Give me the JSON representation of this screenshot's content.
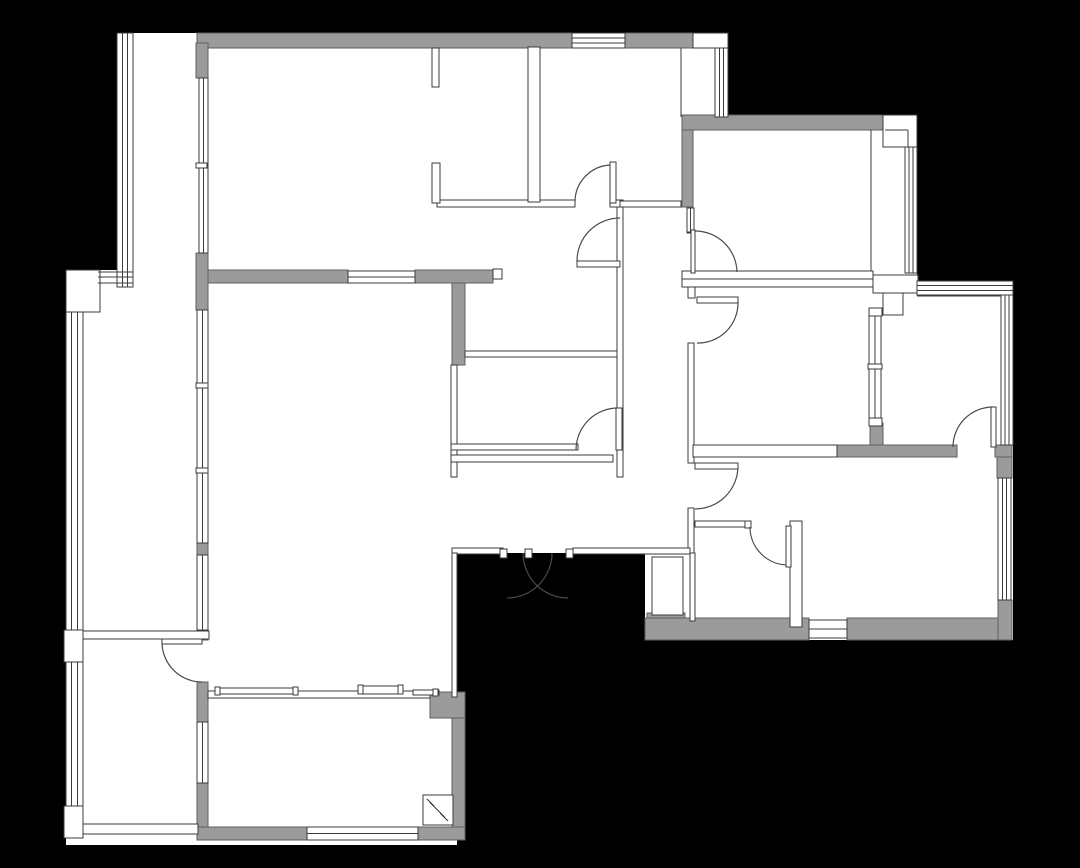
{
  "canvas": {
    "width": 1080,
    "height": 868,
    "background": "#000000"
  },
  "palette": {
    "floor": "#ffffff",
    "wall_fill": "#9b9b9b",
    "wall_edge": "#5f5f5f",
    "line": "#3b3b3b",
    "arc": "#4a4a4a"
  },
  "floor_plan": {
    "floors": [
      [
        117,
        33,
        610,
        250
      ],
      [
        682,
        115,
        235,
        168
      ],
      [
        682,
        281,
        331,
        182
      ],
      [
        645,
        445,
        368,
        195
      ],
      [
        430,
        200,
        265,
        353
      ],
      [
        66,
        270,
        391,
        575
      ]
    ],
    "gray_walls": [
      [
        197,
        33,
        375,
        15
      ],
      [
        625,
        33,
        68,
        15
      ],
      [
        196,
        43,
        12,
        35
      ],
      [
        196,
        253,
        12,
        57
      ],
      [
        208,
        270,
        140,
        13
      ],
      [
        415,
        270,
        78,
        13
      ],
      [
        452,
        283,
        13,
        82
      ],
      [
        682,
        115,
        201,
        15
      ],
      [
        682,
        130,
        11,
        77
      ],
      [
        197,
        543,
        11,
        12
      ],
      [
        197,
        630,
        11,
        10
      ],
      [
        197,
        682,
        11,
        40
      ],
      [
        197,
        783,
        11,
        57
      ],
      [
        452,
        697,
        13,
        143
      ],
      [
        197,
        827,
        110,
        13
      ],
      [
        418,
        827,
        47,
        13
      ],
      [
        430,
        692,
        35,
        26
      ],
      [
        647,
        613,
        38,
        27
      ],
      [
        645,
        618,
        164,
        22
      ],
      [
        847,
        618,
        165,
        22
      ],
      [
        870,
        423,
        13,
        34
      ],
      [
        837,
        445,
        120,
        12
      ],
      [
        995,
        445,
        17,
        12
      ],
      [
        997,
        457,
        15,
        21
      ],
      [
        998,
        600,
        14,
        40
      ]
    ],
    "thin_walls": [
      [
        437,
        200,
        138,
        7
      ],
      [
        610,
        200,
        13,
        7
      ],
      [
        620,
        201,
        61,
        6
      ],
      [
        432,
        48,
        7,
        39
      ],
      [
        432,
        163,
        8,
        40
      ],
      [
        528,
        47,
        12,
        155
      ],
      [
        465,
        351,
        155,
        6
      ],
      [
        451,
        365,
        6,
        112
      ],
      [
        451,
        444,
        127,
        6
      ],
      [
        451,
        455,
        162,
        7
      ],
      [
        617,
        207,
        6,
        270
      ],
      [
        688,
        272,
        7,
        26
      ],
      [
        688,
        343,
        6,
        120
      ],
      [
        688,
        508,
        6,
        45
      ],
      [
        452,
        548,
        51,
        6
      ],
      [
        573,
        548,
        117,
        6
      ],
      [
        452,
        553,
        5,
        144
      ],
      [
        695,
        521,
        52,
        6
      ],
      [
        790,
        521,
        12,
        106
      ],
      [
        690,
        553,
        5,
        68
      ],
      [
        682,
        271,
        191,
        16
      ],
      [
        873,
        275,
        45,
        18
      ],
      [
        883,
        293,
        20,
        22
      ],
      [
        83,
        824,
        115,
        10
      ],
      [
        83,
        631,
        126,
        8
      ],
      [
        208,
        691,
        222,
        7
      ],
      [
        693,
        445,
        144,
        12
      ]
    ],
    "boxes": [
      [
        66,
        270,
        34,
        42
      ],
      [
        64,
        630,
        19,
        32
      ],
      [
        64,
        806,
        19,
        32
      ],
      [
        693,
        33,
        35,
        15
      ],
      [
        883,
        115,
        34,
        32
      ],
      [
        652,
        557,
        31,
        58
      ],
      [
        493,
        269,
        9,
        10
      ],
      [
        423,
        795,
        30,
        30
      ],
      [
        869,
        308,
        13,
        8
      ],
      [
        869,
        418,
        13,
        8
      ],
      [
        687,
        228,
        7,
        5
      ],
      [
        745,
        521,
        6,
        7
      ],
      [
        500,
        549,
        7,
        9
      ],
      [
        525,
        549,
        7,
        9
      ],
      [
        566,
        549,
        7,
        9
      ]
    ],
    "windows": [
      [
        572,
        33,
        53,
        15,
        "h",
        2
      ],
      [
        715,
        48,
        13,
        69,
        "v",
        2
      ],
      [
        199,
        78,
        9,
        175,
        "v",
        1
      ],
      [
        197,
        310,
        11,
        233,
        "v",
        1
      ],
      [
        197,
        555,
        11,
        75,
        "v",
        1
      ],
      [
        197,
        722,
        11,
        61,
        "v",
        1
      ],
      [
        117,
        33,
        16,
        254,
        "v",
        2
      ],
      [
        66,
        312,
        17,
        318,
        "v",
        2
      ],
      [
        66,
        662,
        17,
        144,
        "v",
        2
      ],
      [
        687,
        208,
        7,
        24,
        "v",
        1
      ],
      [
        905,
        147,
        12,
        126,
        "v",
        2
      ],
      [
        917,
        281,
        96,
        14,
        "h",
        2
      ],
      [
        1001,
        295,
        12,
        150,
        "v",
        2
      ],
      [
        998,
        478,
        13,
        122,
        "v",
        2
      ],
      [
        809,
        620,
        38,
        18,
        "h",
        1
      ],
      [
        307,
        827,
        111,
        13,
        "h",
        1
      ],
      [
        869,
        316,
        12,
        102,
        "v",
        1
      ],
      [
        348,
        271,
        67,
        12,
        "h",
        1
      ]
    ],
    "lines": [
      [
        871,
        130,
        871,
        271
      ],
      [
        681,
        48,
        681,
        117
      ],
      [
        682,
        279,
        873,
        279
      ],
      [
        917,
        296,
        1001,
        296
      ],
      [
        885,
        130,
        908,
        130
      ],
      [
        908,
        130,
        908,
        147
      ],
      [
        98,
        272,
        133,
        272
      ],
      [
        98,
        277,
        133,
        277
      ],
      [
        98,
        283,
        133,
        283
      ],
      [
        427,
        799,
        448,
        821
      ]
    ],
    "sills": [
      [
        215,
        688,
        83,
        6
      ],
      [
        358,
        686,
        45,
        8
      ],
      [
        413,
        690,
        26,
        5
      ]
    ],
    "ticks": [
      [
        196,
        163,
        11,
        5
      ],
      [
        196,
        383,
        12,
        5
      ],
      [
        196,
        468,
        12,
        5
      ],
      [
        868,
        364,
        14,
        5
      ],
      [
        215,
        687,
        5,
        8
      ],
      [
        293,
        687,
        5,
        8
      ],
      [
        358,
        685,
        5,
        9
      ],
      [
        398,
        685,
        5,
        9
      ],
      [
        433,
        689,
        5,
        7
      ]
    ],
    "doors": [
      {
        "name": "door-top-middle-room",
        "leaf": [
          610,
          162,
          6,
          41
        ],
        "arc": "M575,202 A37,37 0 0 1 611,165"
      },
      {
        "name": "door-north-corridor",
        "leaf": [
          577,
          261,
          43,
          6
        ],
        "arc": "M577,261 A43,43 0 0 1 620,218"
      },
      {
        "name": "door-kitchen",
        "leaf": [
          616,
          408,
          6,
          42
        ],
        "arc": "M576,450 A42,42 0 0 1 618,408"
      },
      {
        "name": "door-ne-bedroom",
        "leaf": [
          691,
          230,
          4,
          43
        ],
        "arc": "M737,272 A42,42 0 0 0 695,231"
      },
      {
        "name": "door-mid-right-room",
        "leaf": [
          697,
          297,
          41,
          6
        ],
        "arc": "M738,302 A40,40 0 0 1 697,343"
      },
      {
        "name": "door-se-room",
        "leaf": [
          695,
          463,
          43,
          6
        ],
        "arc": "M738,466 A43,43 0 0 1 695,509"
      },
      {
        "name": "door-small-bath",
        "leaf": [
          786,
          526,
          5,
          41
        ],
        "arc": "M750,527 A38,38 0 0 0 788,565"
      },
      {
        "name": "door-east-study",
        "leaf": [
          991,
          407,
          5,
          40
        ],
        "arc": "M953,447 A40,40 0 0 1 993,407"
      },
      {
        "name": "door-balcony-divider",
        "leaf": [
          162,
          639,
          40,
          5
        ],
        "arc": "M162,642 A40,40 0 0 0 202,682"
      },
      {
        "name": "entry-door-left",
        "leaf": null,
        "arc": "M552,553 A45,45 0 0 1 507,598"
      },
      {
        "name": "entry-door-right",
        "leaf": null,
        "arc": "M523,553 A45,45 0 0 0 568,598"
      }
    ]
  }
}
